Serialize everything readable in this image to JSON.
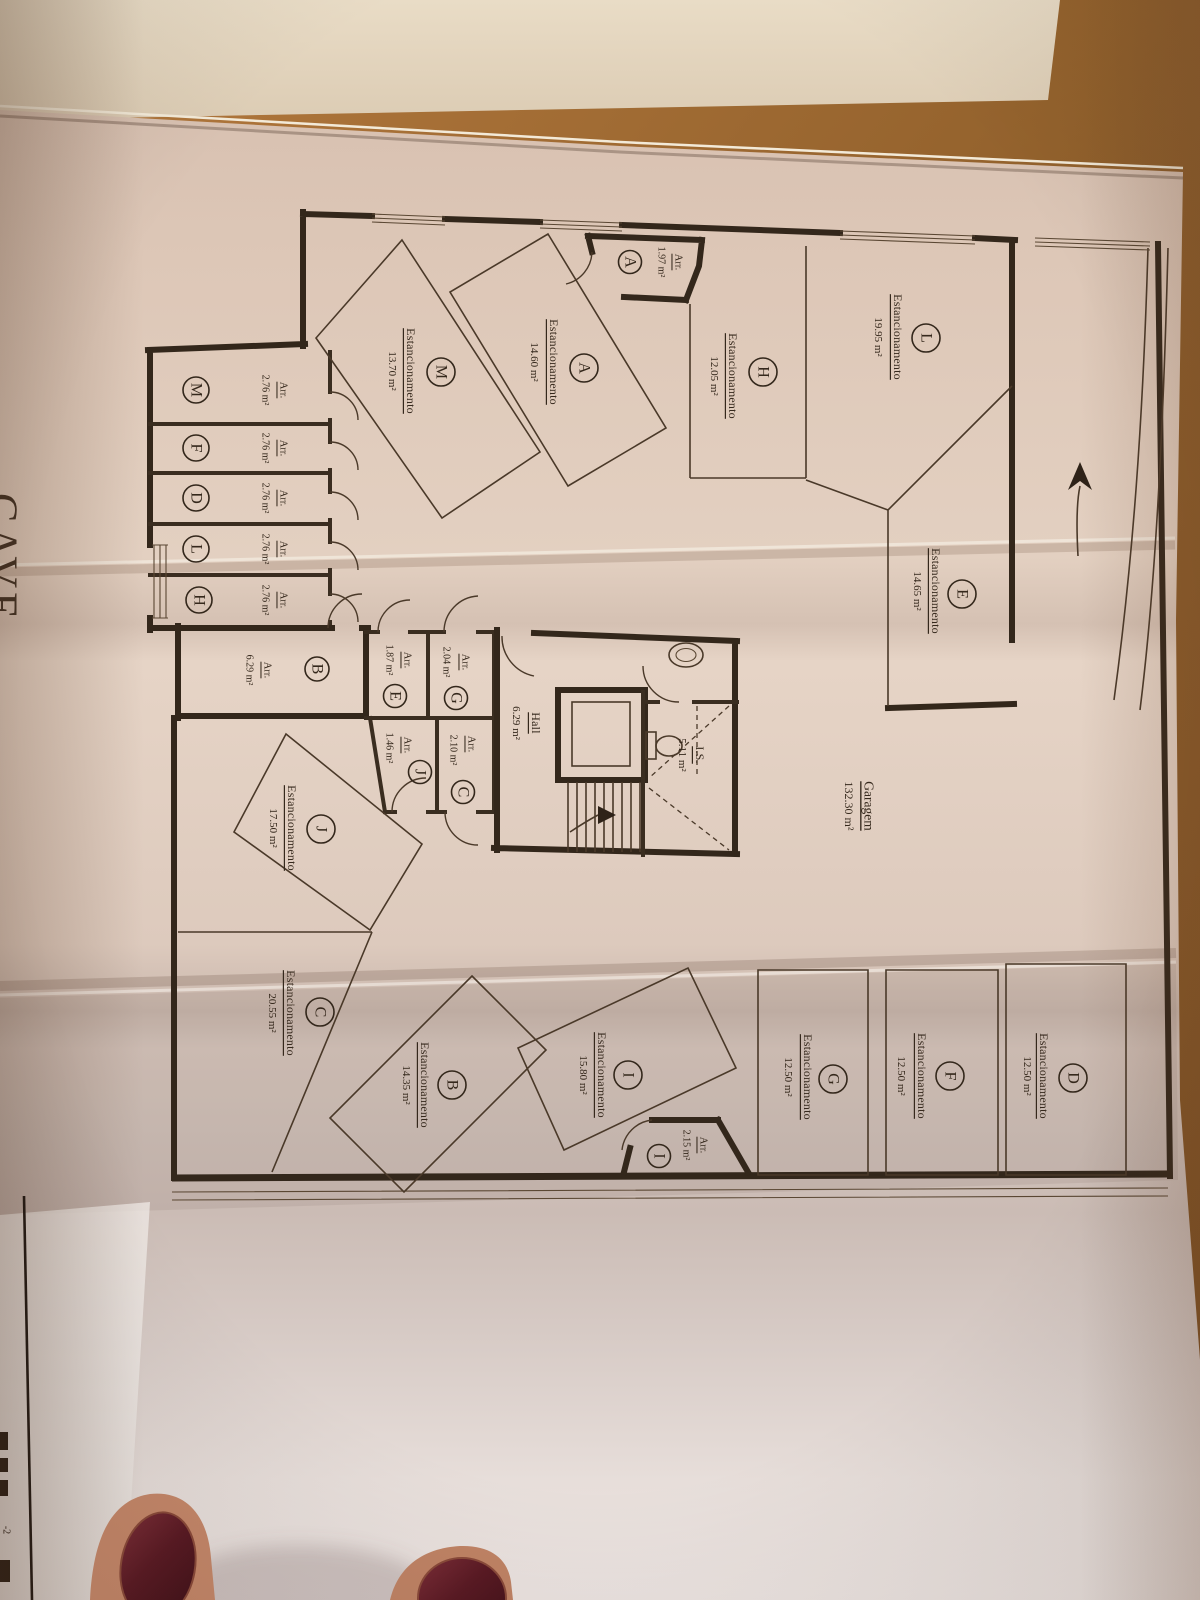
{
  "title": "CAVE",
  "plan": {
    "parking_label": "Estancionamento",
    "storage_label": "Arr.",
    "garage": {
      "label": "Garagem",
      "area": "132.30 m²"
    },
    "hall": {
      "label": "Hall",
      "area": "6.29 m²"
    },
    "wc": {
      "label": "I.S.",
      "area": "5.11 m²"
    },
    "parking": [
      {
        "id": "L",
        "area": "19.95 m²"
      },
      {
        "id": "A",
        "area": "14.60 m²"
      },
      {
        "id": "M",
        "area": "13.70 m²"
      },
      {
        "id": "H",
        "area": "12.05 m²"
      },
      {
        "id": "E",
        "area": "14.65 m²"
      },
      {
        "id": "J",
        "area": "17.50 m²"
      },
      {
        "id": "C",
        "area": "20.55 m²"
      },
      {
        "id": "B",
        "area": "14.35 m²"
      },
      {
        "id": "I",
        "area": "15.80 m²"
      },
      {
        "id": "G",
        "area": "12.50 m²"
      },
      {
        "id": "F",
        "area": "12.50 m²"
      },
      {
        "id": "D",
        "area": "12.50 m²"
      }
    ],
    "storage": [
      {
        "id": "A",
        "area": "1.97 m²"
      },
      {
        "id": "M",
        "area": "2.76 m²"
      },
      {
        "id": "F",
        "area": "2.76 m²"
      },
      {
        "id": "D",
        "area": "2.76 m²"
      },
      {
        "id": "L",
        "area": "2.76 m²"
      },
      {
        "id": "H",
        "area": "2.76 m²"
      },
      {
        "id": "B",
        "area": "6.29 m²"
      },
      {
        "id": "E",
        "area": "1.87 m²"
      },
      {
        "id": "G",
        "area": "2.04 m²"
      },
      {
        "id": "J",
        "area": "1.46 m²"
      },
      {
        "id": "C",
        "area": "2.10 m²"
      },
      {
        "id": "I",
        "area": "2.15 m²"
      }
    ],
    "corner_note": "-2"
  },
  "colors": {
    "paper": "#e2cfc0",
    "ink": "#33271b",
    "wood": "#a06a33",
    "nail_polish": "#5a1a24",
    "skin": "#c38165"
  }
}
